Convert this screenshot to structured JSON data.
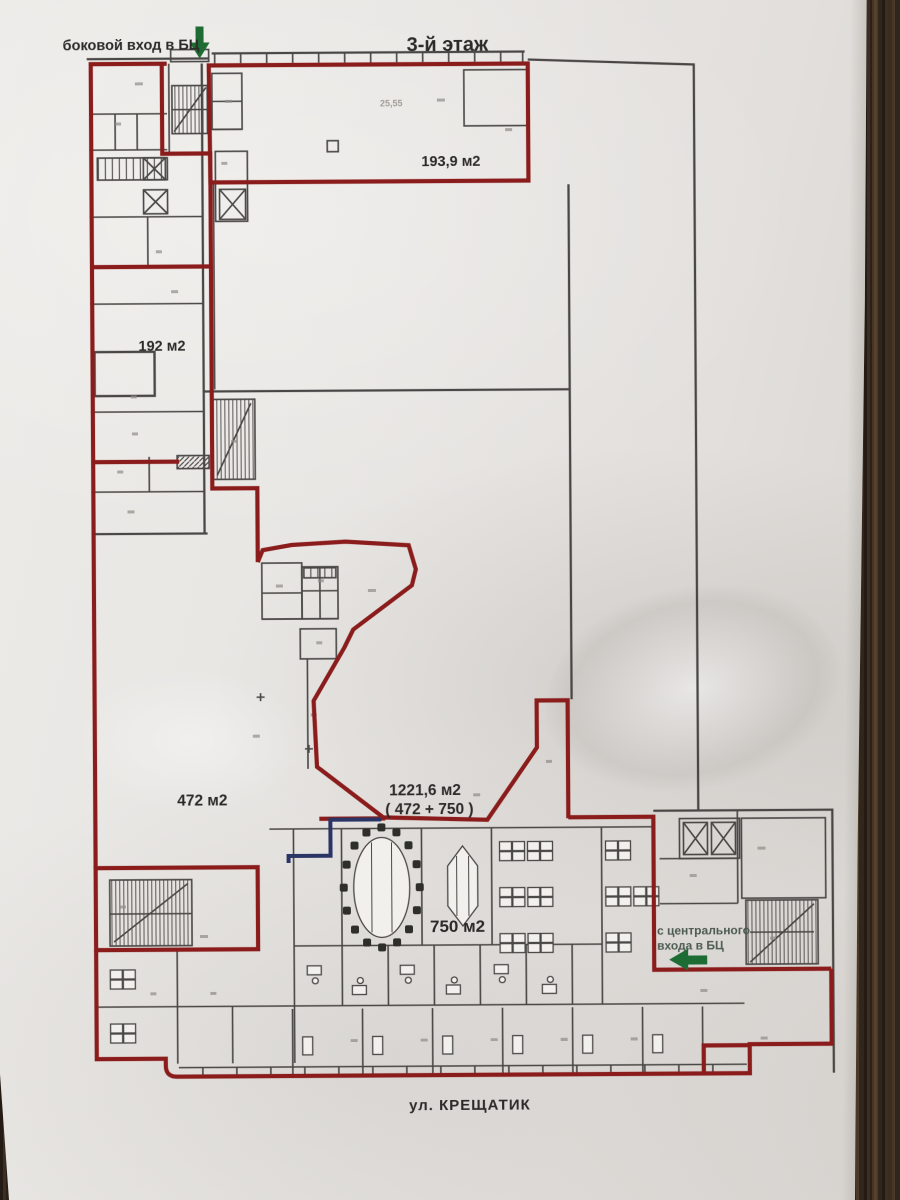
{
  "title": "3-й этаж",
  "entrances": {
    "side": "боковой вход в БЦ",
    "central_line1": "с центрального",
    "central_line2": "входа в БЦ"
  },
  "street": "ул. КРЕЩАТИК",
  "areas": {
    "zone_top": "193,9 м2",
    "zone_left": "192 м2",
    "zone_middle": "472 м2",
    "zone_total": "1221,6 м2",
    "zone_total_note": "( 472 + 750 )",
    "zone_bottom": "750 м2",
    "room_dim_note": "25,55"
  },
  "colors": {
    "boundary_red": "#8a1e1e",
    "arrow_green": "#1d6c33",
    "accent_navy": "#2a3566",
    "wall_black": "#4a4744",
    "paper": "#e8e6e3",
    "wood": "#2e231a"
  }
}
